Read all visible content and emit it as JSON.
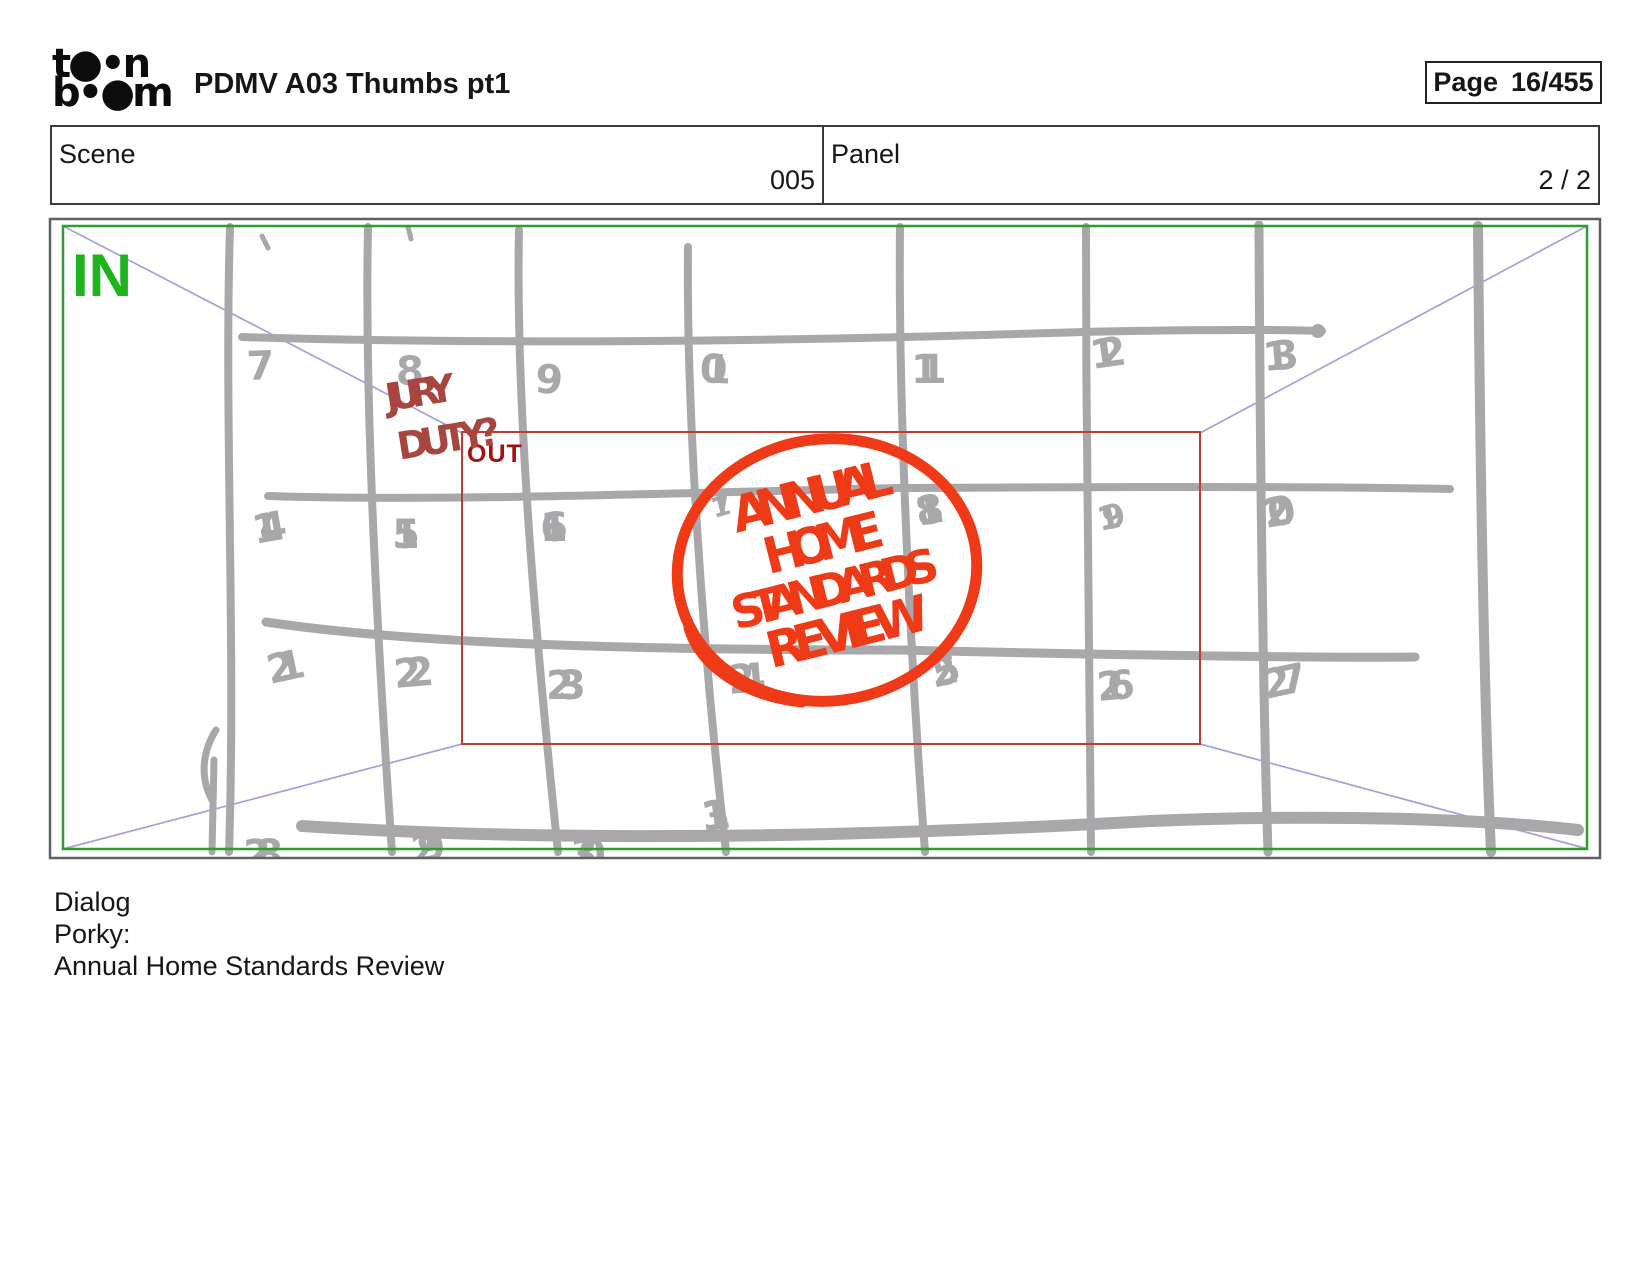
{
  "header": {
    "logo_line1": "t●•n",
    "logo_line2": "b•●m",
    "title": "PDMV A03 Thumbs pt1",
    "page_label": "Page",
    "page_value": "16/455"
  },
  "info": {
    "scene_label": "Scene",
    "scene_value": "005",
    "panel_label": "Panel",
    "panel_value": "2 / 2"
  },
  "board": {
    "in_label": "IN",
    "out_label": "OUT",
    "note_line1": "JURY",
    "note_line2": "DUTY?",
    "circle_lines": [
      "ANNUAL",
      "HOME",
      "STANDARDS",
      "REVIEW"
    ],
    "days_row1": [
      "7",
      "8",
      "9",
      "10",
      "11",
      "12",
      "13"
    ],
    "days_row2": [
      "14",
      "15",
      "16",
      "17",
      "18",
      "19",
      "20"
    ],
    "days_row3": [
      "21",
      "22",
      "23",
      "24",
      "25",
      "26",
      "27"
    ],
    "days_row4": [
      "28",
      "29",
      "30",
      "31"
    ]
  },
  "dialog": {
    "label": "Dialog",
    "speaker": "Porky:",
    "line": "Annual Home Standards Review"
  },
  "colors": {
    "frame_green": "#2f9e32",
    "in_green": "#1db41d",
    "marker_red": "#ee3a17",
    "out_red": "#a31111",
    "note_red": "#a6463e",
    "camera_rect_red": "#c03a2e",
    "grid_gray": "#a8a8aa",
    "diagonal_blue": "#a2a2d8",
    "border_gray": "#606060"
  }
}
